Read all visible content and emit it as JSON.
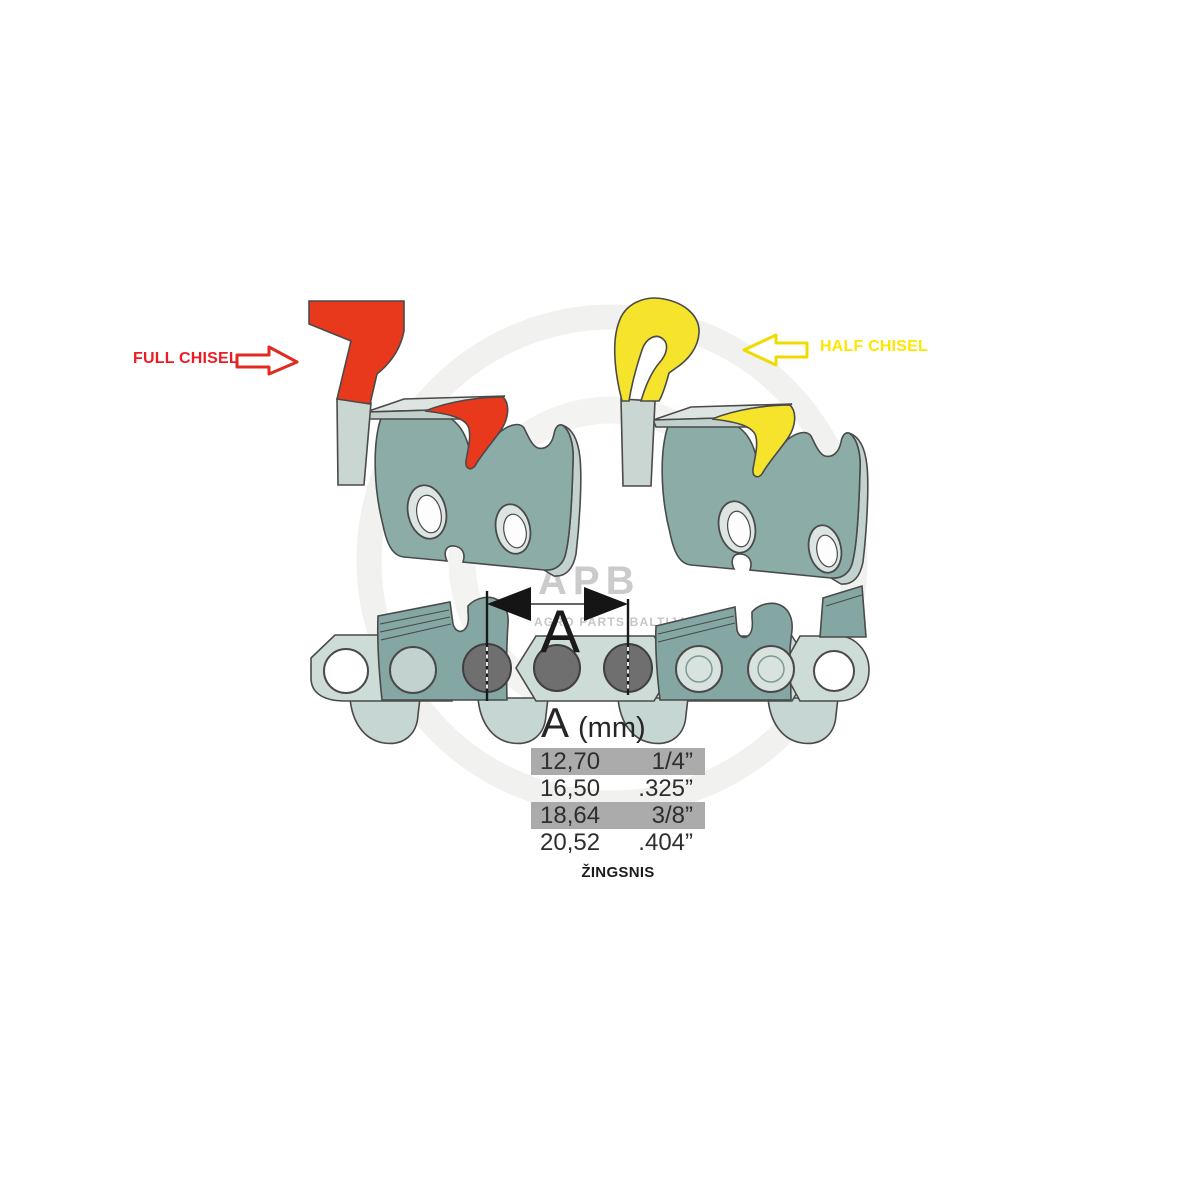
{
  "labels": {
    "full_chisel": "FULL CHISEL",
    "half_chisel": "HALF CHISEL",
    "dimension_letter": "A"
  },
  "pitch_table": {
    "header_letter": "A",
    "header_unit": "(mm)",
    "caption": "ŽINGSNIS",
    "rows": [
      {
        "mm": "12,70",
        "inch": "1/4”",
        "highlighted": true
      },
      {
        "mm": "16,50",
        "inch": ".325”",
        "highlighted": false
      },
      {
        "mm": "18,64",
        "inch": "3/8”",
        "highlighted": true
      },
      {
        "mm": "20,52",
        "inch": ".404”",
        "highlighted": false
      }
    ]
  },
  "watermark": {
    "brand": "APB",
    "subtitle": "AGRO PARTS BALTIJA"
  },
  "colors": {
    "full_chisel_red": "#E8391D",
    "half_chisel_yellow": "#F5E32C",
    "label_red": "#ED1C24",
    "label_yellow": "#FFE600",
    "arrow_red_outline": "#E02B20",
    "arrow_yellow_outline": "#F0DB00",
    "cutter_teal": "#8CACA8",
    "chain_light": "#CEDCD8",
    "rivet_gray": "#6F6F6F",
    "row_highlight": "#ABABAB"
  }
}
